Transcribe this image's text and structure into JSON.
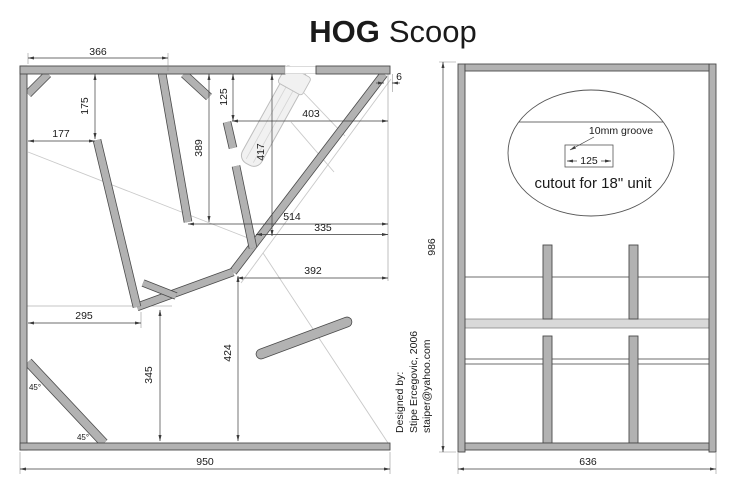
{
  "title": {
    "bold": "HOG",
    "regular": "Scoop"
  },
  "side_view": {
    "dim_top_width": "366",
    "dim_175": "175",
    "dim_177": "177",
    "dim_125": "125",
    "dim_403": "403",
    "dim_417": "417",
    "dim_389": "389",
    "dim_6": "6",
    "dim_514": "514",
    "dim_335": "335",
    "dim_392": "392",
    "dim_295": "295",
    "dim_345": "345",
    "dim_424": "424",
    "dim_total_width": "950",
    "angle_top": "45°",
    "angle_bottom": "45°"
  },
  "front_view": {
    "groove_note": "10mm groove",
    "dim_groove": "125",
    "cutout_note": "cutout for 18\" unit",
    "dim_total_height": "986",
    "dim_total_width": "636"
  },
  "credit": {
    "line1": "Designed by:",
    "line2": "Stipe Ercegovic, 2006",
    "line3": "staiper@yahoo.com"
  }
}
